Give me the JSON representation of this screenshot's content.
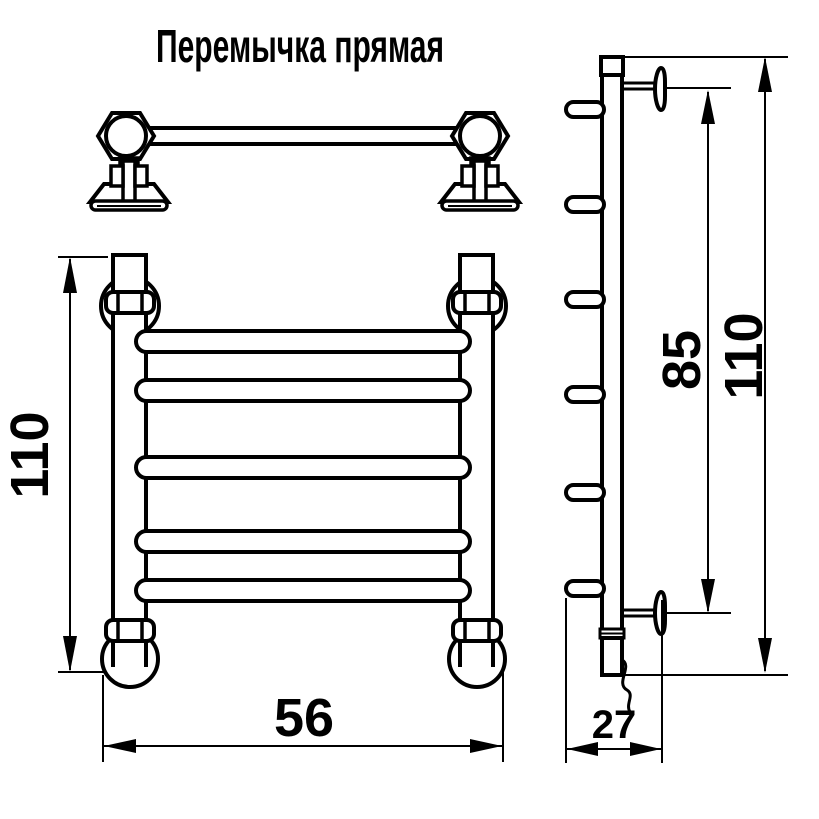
{
  "title": "Перемычка прямая",
  "colors": {
    "line": "#000000",
    "background": "#ffffff"
  },
  "dimensions": {
    "front_height": "110",
    "front_width": "56",
    "side_bracket_span": "85",
    "side_total_height": "110",
    "side_depth": "27"
  }
}
